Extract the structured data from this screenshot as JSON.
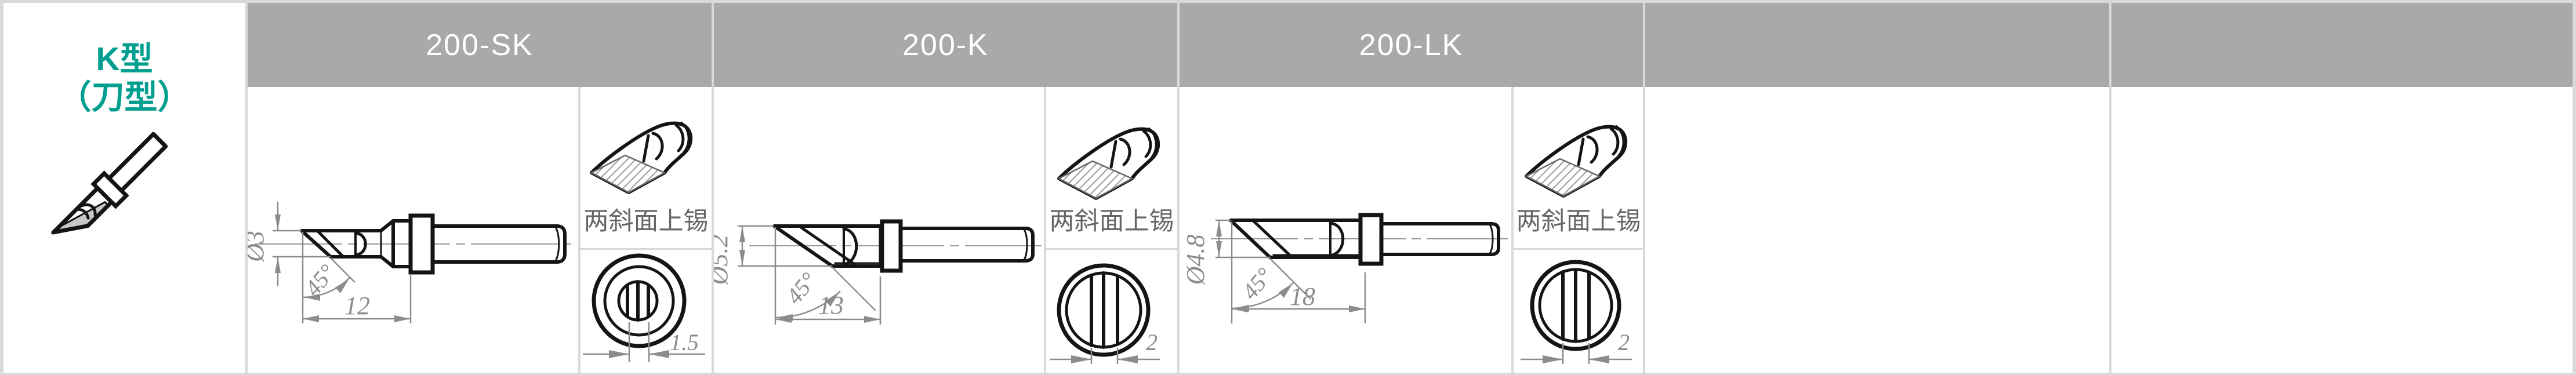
{
  "row_header": {
    "type_line1": "K型",
    "type_line2": "（刀型）"
  },
  "products": [
    {
      "model": "200-SK",
      "dimensions": {
        "diameter": "Ø3",
        "angle": "45°",
        "length": "12",
        "tip_width": "1.5"
      },
      "tinning_note": "两斜面上锡"
    },
    {
      "model": "200-K",
      "dimensions": {
        "diameter": "Ø5.2",
        "angle": "45°",
        "length": "13",
        "tip_width": "2"
      },
      "tinning_note": "两斜面上锡"
    },
    {
      "model": "200-LK",
      "dimensions": {
        "diameter": "Ø4.8",
        "angle": "45°",
        "length": "18",
        "tip_width": "2"
      },
      "tinning_note": "两斜面上锡"
    }
  ],
  "empty_columns": 2,
  "colors": {
    "accent_teal": "#009E8F",
    "header_bg": "#A9A9A9",
    "grid_gray": "#D9D9D9",
    "dimension_gray": "#8C8C8C",
    "drawing_black": "#141414"
  }
}
